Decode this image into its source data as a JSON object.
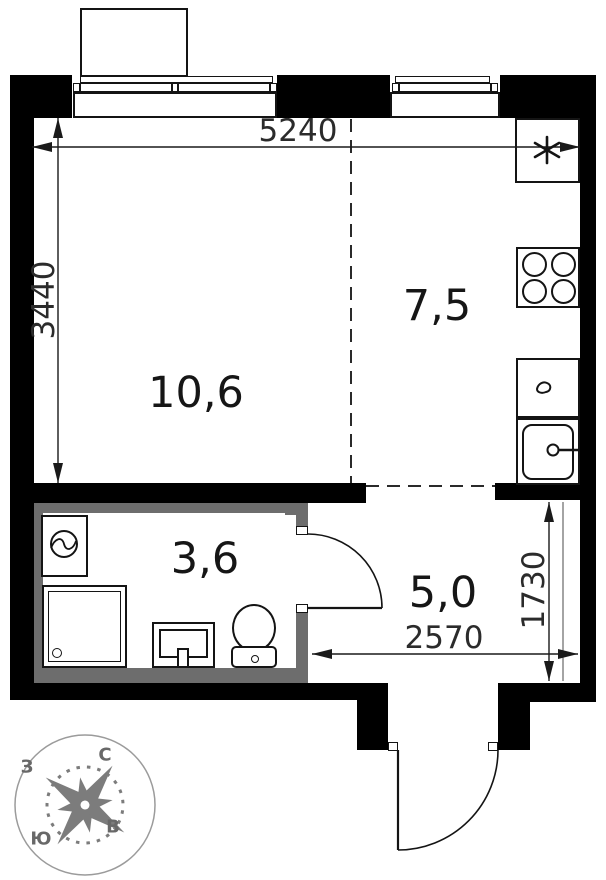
{
  "plan": {
    "title": "studio-apartment-floor-plan",
    "rooms": [
      {
        "name": "living-room",
        "area": "10,6"
      },
      {
        "name": "kitchen",
        "area": "7,5"
      },
      {
        "name": "bathroom",
        "area": "3,6"
      },
      {
        "name": "hallway",
        "area": "5,0"
      }
    ],
    "dimensions": {
      "top_width_mm": "5240",
      "left_height_mm": "3440",
      "hallway_height_mm": "1730",
      "hallway_width_mm": "2570"
    },
    "compass": {
      "north": "С",
      "south": "Ю",
      "west": "З",
      "east": "В"
    },
    "icons": {
      "vent_shaft": "six-spoke-asterisk",
      "stove": "four-burner-cooktop",
      "kitchen_sink": "single-basin-sink-with-faucet",
      "counter_drop": "teardrop",
      "washing_machine": "washer-drum",
      "shower": "shower-tray-with-drain",
      "wash_basin": "pedestal-basin",
      "toilet": "toilet-with-cistern",
      "compass_rose": "eight-point-star"
    },
    "colors": {
      "wall": "#000000",
      "wet_wall": "#6d6d6d",
      "line": "#141414",
      "dim": "#2b2b2b",
      "compass": "#7c7c7c",
      "compass_text": "#686868"
    }
  }
}
